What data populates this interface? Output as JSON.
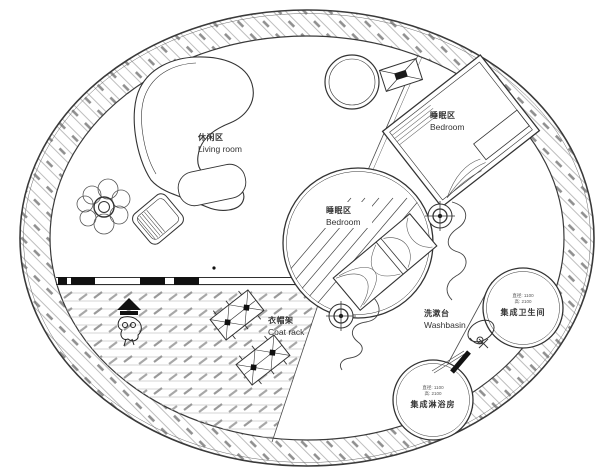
{
  "app": {
    "type": "circular-tiny-house-floor-plan",
    "background": "#ffffff"
  },
  "colors": {
    "line": "#2f2f2f",
    "hatch_light": "#c4c4c4",
    "hatch_dark": "#9a9a9a",
    "text": "#333333",
    "fill": "#ffffff",
    "black_fixture": "#111111"
  },
  "labels": {
    "living": {
      "zh": "休闲区",
      "en": "Living room"
    },
    "bedroom_top": {
      "zh": "睡眠区",
      "en": "Bedroom"
    },
    "bedroom_pod": {
      "zh": "睡眠区",
      "en": "Bedroom"
    },
    "coat_rack": {
      "zh": "衣帽架",
      "en": "Coat rack"
    },
    "washbasin": {
      "zh": "洗漱台",
      "en": "Washbasin"
    },
    "bathroom": {
      "name": "集成卫生间",
      "spec_line1": "直径: 1100",
      "spec_line2": "高: 2100"
    },
    "shower": {
      "name": "集成淋浴房",
      "spec_line1": "直径: 1100",
      "spec_line2": "高: 2100"
    }
  }
}
